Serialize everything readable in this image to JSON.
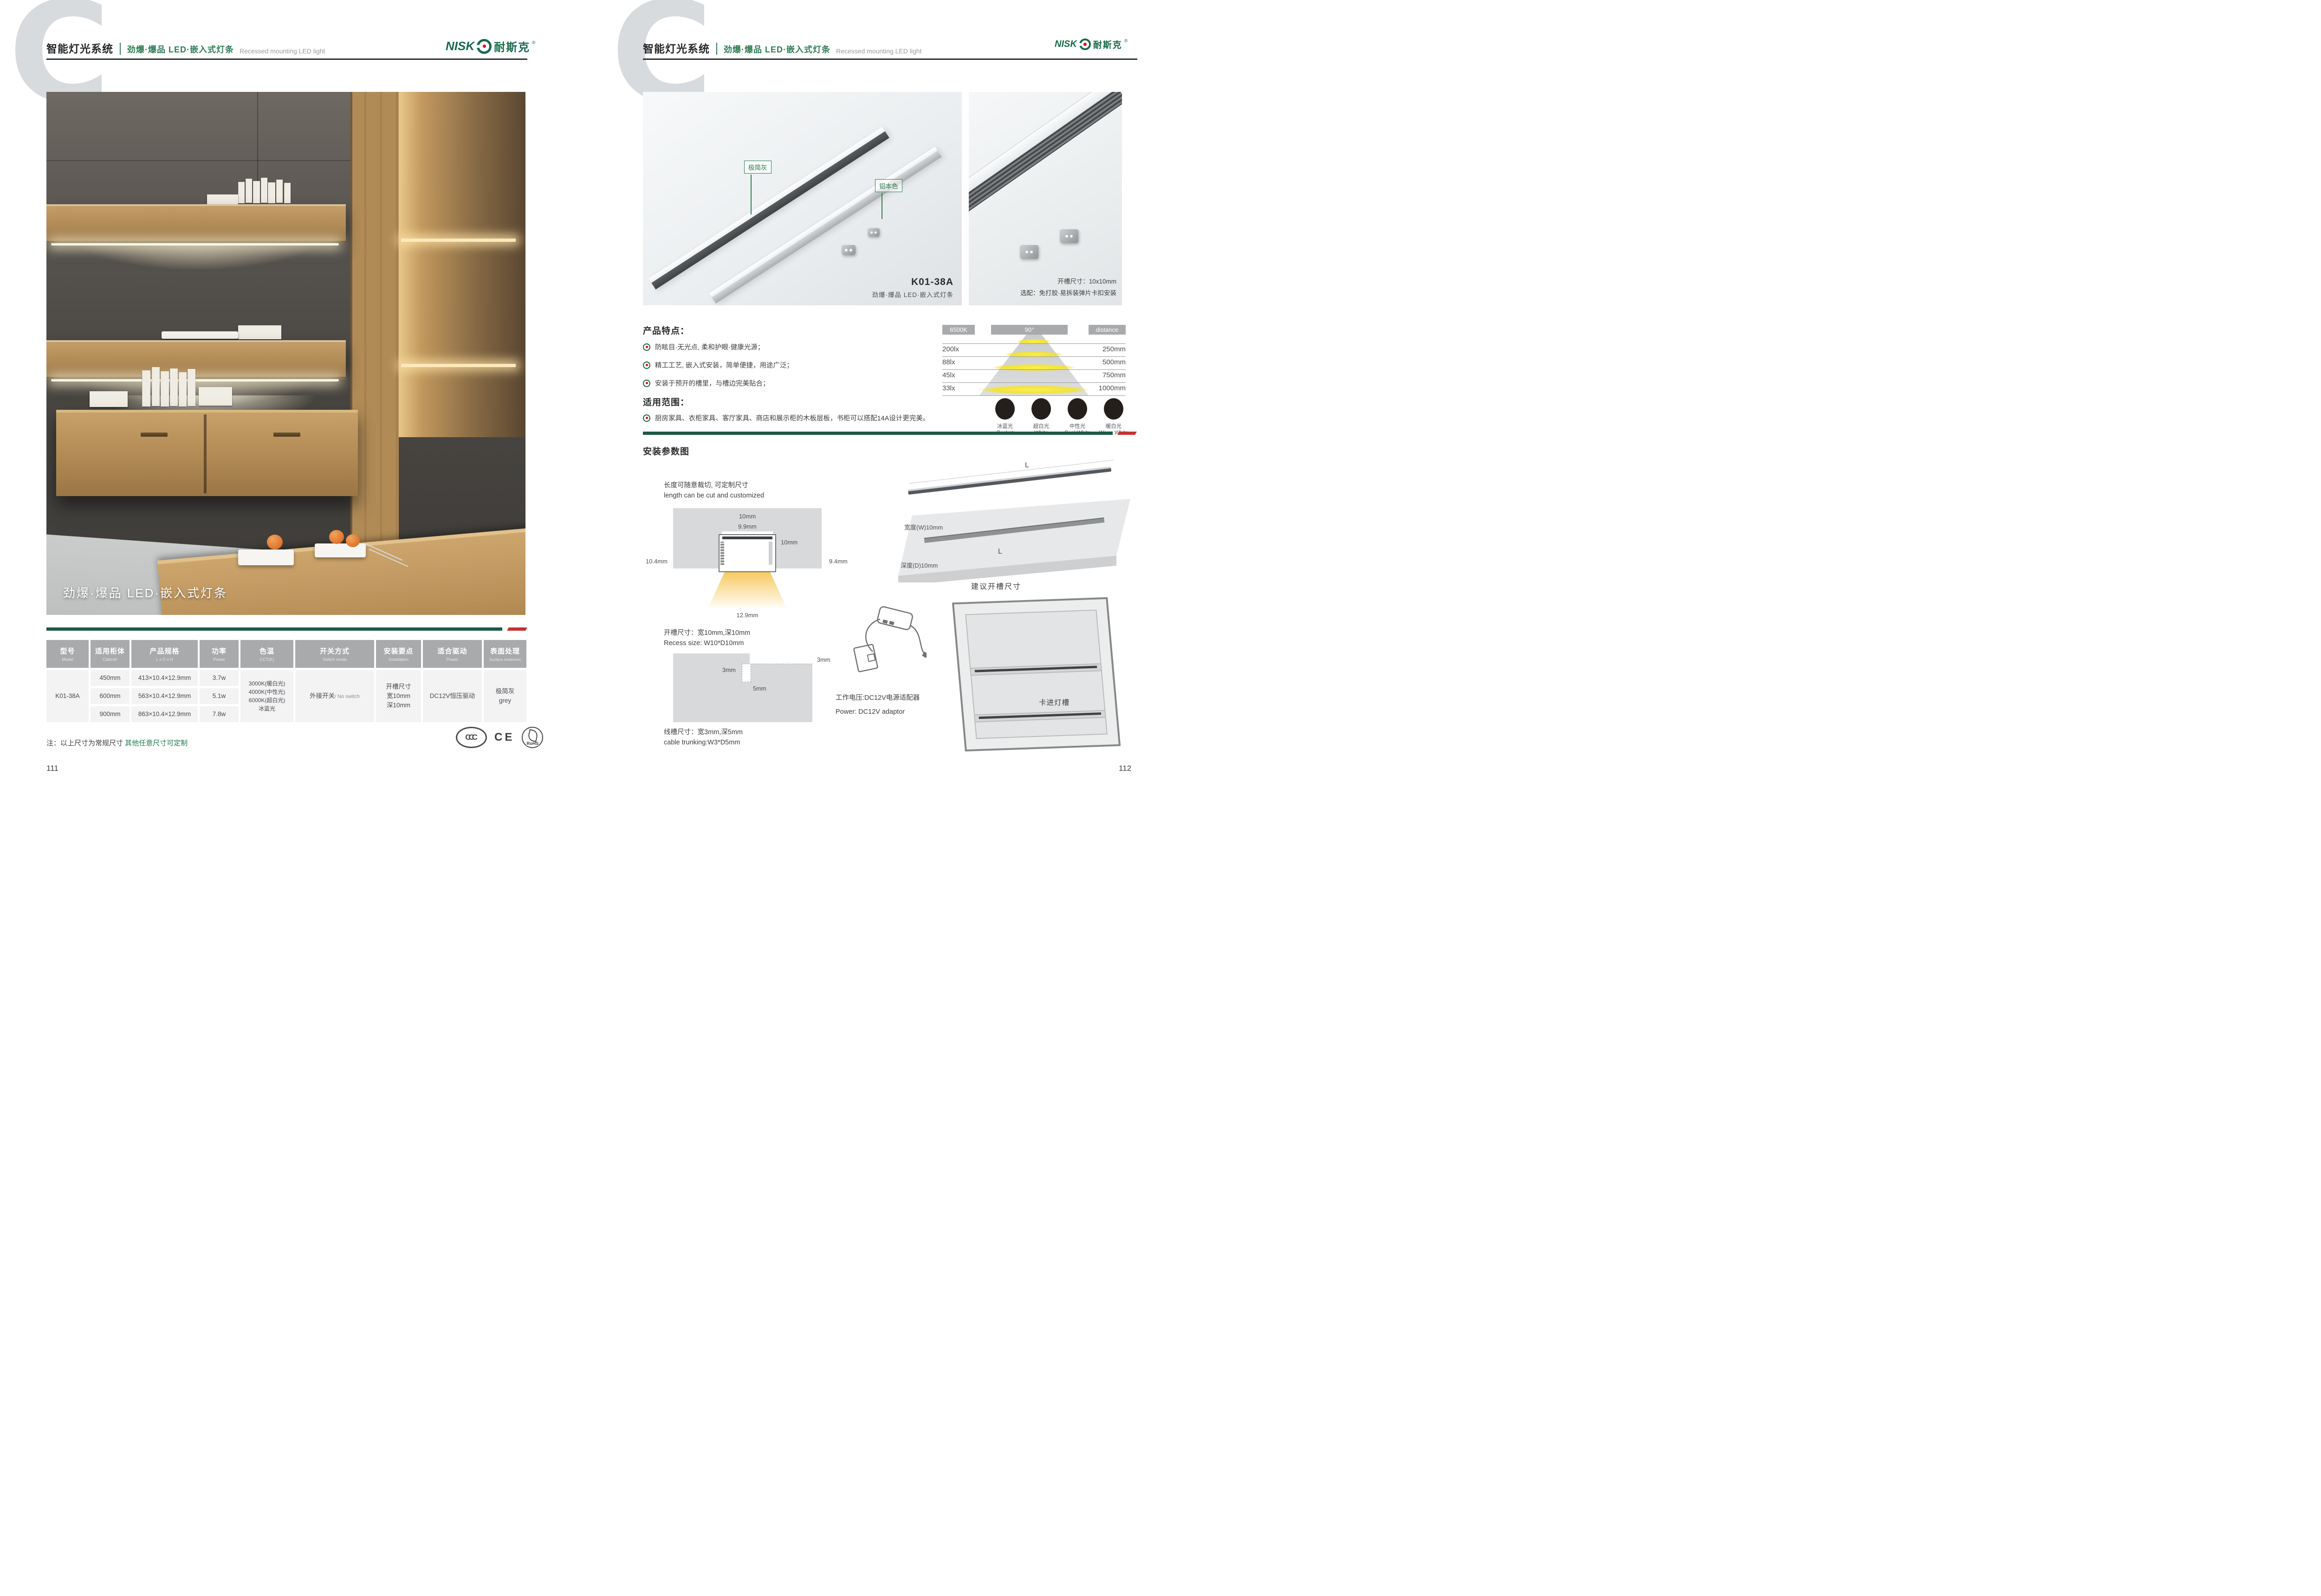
{
  "brand": {
    "latin": "NISK",
    "cn": "耐斯克",
    "reg": "®"
  },
  "header": {
    "watermark": "C",
    "system": "智能灯光系统",
    "series": "劲爆·爆品  LED·嵌入式灯条",
    "series_en": "Recessed mounting LED light"
  },
  "left_page": {
    "page_number": "111",
    "photo_overlay": "劲爆·爆品  LED·嵌入式灯条",
    "note_black": "注：以上尺寸为常规尺寸 ",
    "note_green": "其他任意尺寸可定制",
    "certs": {
      "ccc": "CCC",
      "ce": "CE",
      "rohs": "RoHS"
    }
  },
  "table": {
    "columns": [
      {
        "cn": "型号",
        "en": "Model"
      },
      {
        "cn": "适用柜体",
        "en": "Cabinet"
      },
      {
        "cn": "产品规格",
        "en": "L x D x H"
      },
      {
        "cn": "功率",
        "en": "Power"
      },
      {
        "cn": "色温",
        "en": "CCT(K)"
      },
      {
        "cn": "开关方式",
        "en": "Switch mode"
      },
      {
        "cn": "安装要点",
        "en": "Installation"
      },
      {
        "cn": "适合驱动",
        "en": "Power"
      },
      {
        "cn": "表面处理",
        "en": "Surface treatment"
      }
    ],
    "model": "K01-38A",
    "rows": [
      {
        "cabinet": "450mm",
        "spec": "413×10.4×12.9mm",
        "power": "3.7w"
      },
      {
        "cabinet": "600mm",
        "spec": "563×10.4×12.9mm",
        "power": "5.1w"
      },
      {
        "cabinet": "900mm",
        "spec": "863×10.4×12.9mm",
        "power": "7.8w"
      }
    ],
    "cct": [
      "3000K(暖白光)",
      "4000K(中性光)",
      "6000K(超白光)",
      "冰蓝光"
    ],
    "switch_cn": "外接开关",
    "switch_en": "/ No switch",
    "install": [
      "开槽尺寸",
      "宽10mm",
      "深10mm"
    ],
    "driver": "DC12V恒压驱动",
    "surface_cn": "极简灰",
    "surface_en": "grey"
  },
  "right_page": {
    "page_number": "112",
    "photo1": {
      "label_grey": "极简灰",
      "label_aluminum": "铝本色",
      "model": "K01-38A",
      "caption": "劲爆·爆品  LED·嵌入式灯条"
    },
    "photo2": {
      "line1": "开槽尺寸：10x10mm",
      "line2": "选配：免打胶·易拆装弹片卡扣安装"
    },
    "features": {
      "title": "产品特点：",
      "items": [
        "防眩目·无光点, 柔和护眼·健康光源；",
        "精工工艺, 嵌入式安装，简单便捷，用途广泛；",
        "安装于预开的槽里，与槽边完美贴合；"
      ]
    },
    "scope": {
      "title": "适用范围：",
      "text": "厨房家具、衣柜家具、客厅家具、商店和展示柜的木板层板，书柜可以搭配14A设计更完美。"
    },
    "install_title": "安装参数图"
  },
  "light_chart": {
    "type": "table",
    "cct": "6500K",
    "angle": "90°",
    "distance_header": "distance",
    "rows": [
      {
        "lux": "200lx",
        "distance": "250mm"
      },
      {
        "lux": "88lx",
        "distance": "500mm"
      },
      {
        "lux": "45lx",
        "distance": "750mm"
      },
      {
        "lux": "33lx",
        "distance": "1000mm"
      }
    ],
    "modes": [
      {
        "cn": "冰蓝光",
        "en": "Basket",
        "color": "#a3d8f0"
      },
      {
        "cn": "超白光",
        "en": "White",
        "color": "#ffffff"
      },
      {
        "cn": "中性光",
        "en": "Cool White",
        "color": "#f5ecd0"
      },
      {
        "cn": "暖白光",
        "en": "Warm White",
        "color": "#f2ca76"
      }
    ]
  },
  "install": {
    "cut_cn": "长度可随意裁切, 可定制尺寸",
    "cut_en": "length can be cut and customized",
    "cross_dims": {
      "top_width": "10mm",
      "inner_width": "9.9mm",
      "depth": "10mm",
      "left_height": "10.4mm",
      "right_height": "9.4mm",
      "bottom_width": "12.9mm"
    },
    "recess_cn": "开槽尺寸：宽10mm,深10mm",
    "recess_en": "Recess size: W10*D10mm",
    "trunk_dims": {
      "right": "3mm",
      "left": "3mm",
      "bottom": "5mm"
    },
    "trunk_cn": "线槽尺寸：宽3mm,深5mm",
    "trunk_en": "cable trunking:W3*D5mm",
    "board": {
      "strip_len": "L",
      "width": "宽度(W)10mm",
      "groove_len": "L",
      "depth": "深度(D)10mm",
      "caption": "建议开槽尺寸"
    },
    "cabinet": {
      "volt_cn": "工作电压:DC12V电源适配器",
      "volt_en": "Power: DC12V adaptor",
      "clip": "卡进灯槽"
    }
  },
  "colors": {
    "brand_green": "#176a49",
    "series_green": "#2f7d54",
    "divider_green": "#1c5b43",
    "divider_red": "#c23430",
    "logo_red": "#e60012",
    "note_green": "#1d7a4f",
    "table_header_gray": "#a8aaac"
  }
}
